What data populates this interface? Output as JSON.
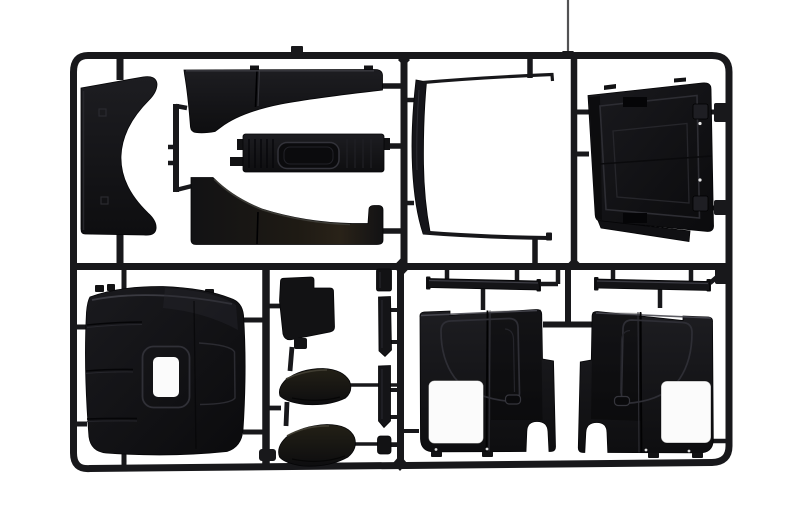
{
  "scene": {
    "type": "product-photograph",
    "subject": "Black injection-molded plastic model kit sprue with truck cab body parts",
    "background": "#ffffff"
  },
  "palette": {
    "background": "#ffffff",
    "runner": "#18181b",
    "plastic_dark": "#121214",
    "plastic_mid": "#1b1b1f",
    "plastic_deep": "#0a0a0c",
    "gloss_brown": "#241f16",
    "highlight": "#3c3c44",
    "cutout_white": "#fbfbfb"
  },
  "sprue": {
    "frame": "rounded rectangular runner frame",
    "runners": [
      "mid-horizontal",
      "vertical-top-left",
      "vertical-top-center",
      "vertical-top-right",
      "vertical-bottom-left",
      "vertical-bottom-center",
      "center-tee"
    ]
  },
  "parts": [
    {
      "id": 0,
      "name": "wind-deflector-panel",
      "position": "top-left",
      "shape": "crescent panel with concave right edge"
    },
    {
      "id": 1,
      "name": "upper-sweep-panel",
      "position": "top-center upper",
      "shape": "hockey-stick band"
    },
    {
      "id": 2,
      "name": "grille-panel",
      "position": "top-center middle",
      "shape": "bar with recessed rounded slot"
    },
    {
      "id": 3,
      "name": "lower-sweep-panel",
      "position": "top-center lower",
      "shape": "mirrored hockey-stick band"
    },
    {
      "id": 4,
      "name": "windshield-frame",
      "position": "top center-right",
      "shape": "thin open C frame"
    },
    {
      "id": 5,
      "name": "rear-cab-panel",
      "position": "top-right",
      "shape": "tilted square panel with hinge bumps"
    },
    {
      "id": 6,
      "name": "cab-back-box",
      "position": "bottom-left",
      "shape": "rounded box with small window cutout"
    },
    {
      "id": 7,
      "name": "step-bracket",
      "position": "bottom center-left",
      "shape": "stepped bracket"
    },
    {
      "id": 8,
      "name": "scoop-upper",
      "position": "bottom center",
      "shape": "glossy curved scoop"
    },
    {
      "id": 9,
      "name": "scoop-lower",
      "position": "bottom center",
      "shape": "glossy curved scoop"
    },
    {
      "id": 10,
      "name": "trim-segment-top",
      "position": "center column",
      "shape": "small block"
    },
    {
      "id": 11,
      "name": "trim-strip-upper",
      "position": "center column",
      "shape": "thin vertical strip"
    },
    {
      "id": 12,
      "name": "trim-strip-lower",
      "position": "center column",
      "shape": "thin vertical strip"
    },
    {
      "id": 13,
      "name": "trim-nub",
      "position": "center column",
      "shape": "small block"
    },
    {
      "id": 14,
      "name": "side-panel-left",
      "position": "bottom-right left",
      "shape": "cab side panel with window cutout and wheel arch"
    },
    {
      "id": 15,
      "name": "side-panel-right",
      "position": "bottom-right right",
      "shape": "mirrored cab side panel with window cutout and wheel arch"
    },
    {
      "id": 16,
      "name": "sill-strip-left",
      "position": "above left side panel",
      "shape": "thin bar"
    },
    {
      "id": 17,
      "name": "sill-strip-right",
      "position": "above right side panel",
      "shape": "thin bar"
    }
  ]
}
